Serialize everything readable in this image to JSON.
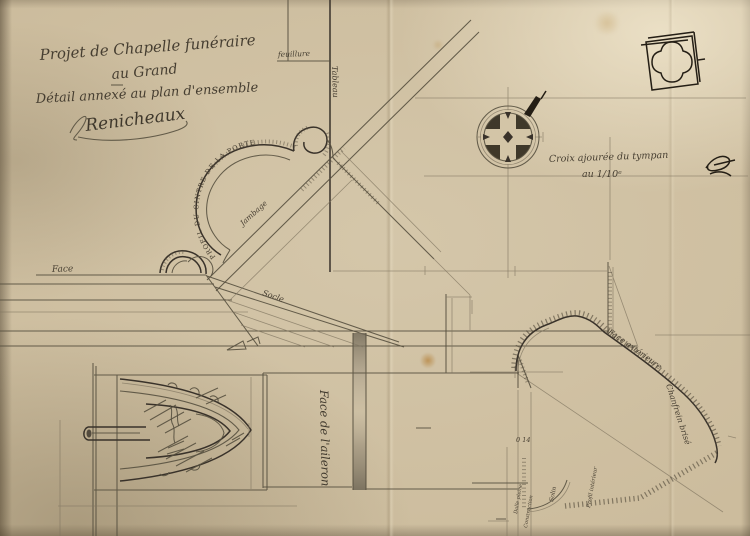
{
  "colors": {
    "paper": "#ccbc9d",
    "graphite": "#463e31",
    "ink": "#241e15",
    "stain": "#b5823c"
  },
  "title_block": {
    "line1": "Projet de Chapelle funéraire",
    "line2": "au Grand",
    "separator": "—",
    "line3": "Détail annexé au plan d'ensemble",
    "signature": "Renicheaux"
  },
  "door_detail": {
    "feuillure_label": "feuillure",
    "tableau_label": "Tableau",
    "arc_label": "PROFIL DU CINTRE DE LA PORTE",
    "jambage_label": "Jambage",
    "face_label": "Face",
    "socle_label": "Socle"
  },
  "tympanum": {
    "caption_line1": "Croix ajourée du tympan",
    "caption_line2": "au 1/10ᵉ"
  },
  "aileron": {
    "face_label": "Face de l'aileron",
    "outer_face_label": "Face extérieure",
    "chamfer_label": "Chanfrein brisé",
    "dim_label": "0 14",
    "solin_label": "Solin",
    "profil_label": "Profil intérieur",
    "dalle_label": "Dalle pleine",
    "construction_label": "Construction"
  }
}
